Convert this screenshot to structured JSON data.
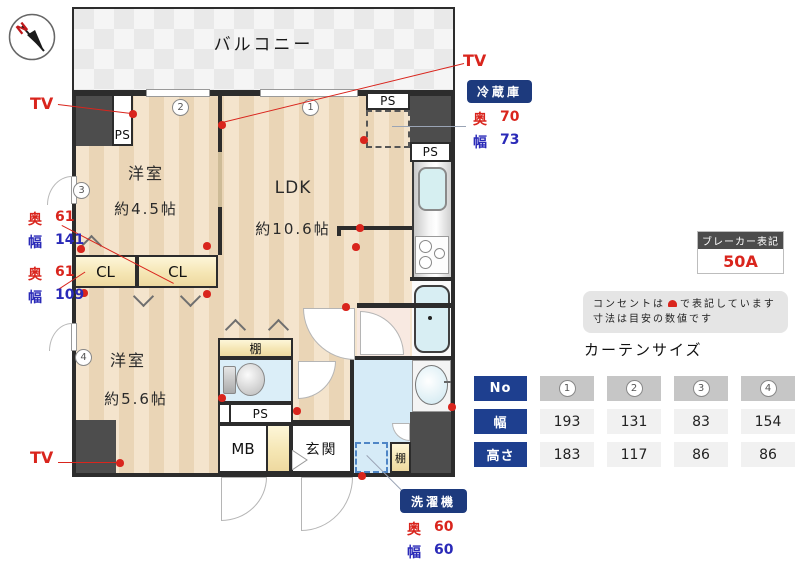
{
  "colors": {
    "accent_red": "#d9251d",
    "accent_blue": "#2a2ab8",
    "badge_navy": "#1d3a7d",
    "table_header_navy": "#1e3f8f",
    "wall": "#2c2c2c"
  },
  "compass": {
    "north_label": "N"
  },
  "plan": {
    "balcony_label": "バルコニー",
    "rooms": {
      "bedroom2": {
        "name": "洋室",
        "size": "約4.5帖"
      },
      "ldk": {
        "name": "LDK",
        "size": "約10.6帖"
      },
      "bedroom4": {
        "name": "洋室",
        "size": "約5.6帖"
      }
    },
    "labels": {
      "ps": "PS",
      "cl": "CL",
      "mb": "MB",
      "entrance": "玄関",
      "shelf": "棚"
    },
    "markers": [
      "1",
      "2",
      "3",
      "4"
    ]
  },
  "annotations": {
    "tv_label": "TV",
    "fridge": {
      "name": "冷蔵庫",
      "depth_label": "奥",
      "depth_value": "70",
      "width_label": "幅",
      "width_value": "73"
    },
    "closet_upper": {
      "depth_label": "奥",
      "depth_value": "61",
      "width_label": "幅",
      "width_value": "141"
    },
    "closet_lower": {
      "depth_label": "奥",
      "depth_value": "61",
      "width_label": "幅",
      "width_value": "109"
    },
    "washer": {
      "name": "洗濯機",
      "depth_label": "奥",
      "depth_value": "60",
      "width_label": "幅",
      "width_value": "60"
    }
  },
  "breaker": {
    "title": "ブレーカー表記",
    "value": "50A"
  },
  "note": {
    "line1_pre": "コンセントは",
    "line1_post": "で表記しています",
    "line2": "寸法は目安の数値です"
  },
  "curtain": {
    "title": "カーテンサイズ",
    "row_headers": [
      "No",
      "幅",
      "高さ"
    ],
    "columns": [
      "1",
      "2",
      "3",
      "4"
    ],
    "widths": [
      "193",
      "131",
      "83",
      "154"
    ],
    "heights": [
      "183",
      "117",
      "86",
      "86"
    ]
  }
}
